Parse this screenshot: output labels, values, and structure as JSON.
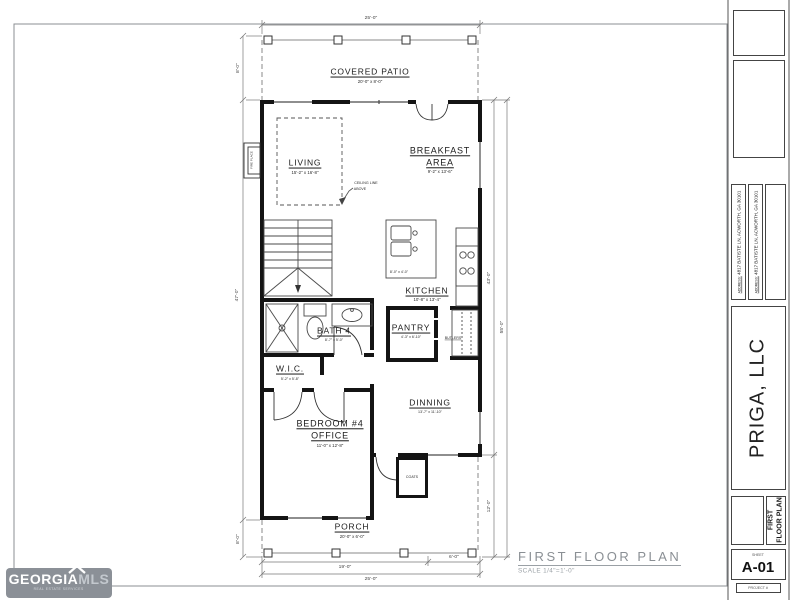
{
  "sheet": {
    "plan_title": "FIRST  FLOOR  PLAN",
    "plan_scale": "SCALE  1/4\"=1'-0\""
  },
  "rooms": {
    "covered_patio": {
      "name": "COVERED PATIO",
      "dims": "20'-0\" x 8'-0\""
    },
    "living": {
      "name": "LIVING",
      "dims": "15'-2\" x 16'-8\""
    },
    "ceiling_note_1": "CEILING LINE",
    "ceiling_note_2": "ABOVE",
    "fireplace": "FIRE PLACE",
    "breakfast": {
      "name1": "BREAKFAST",
      "name2": "AREA",
      "dims": "9'-2\" x 13'-6\""
    },
    "kitchen": {
      "name": "KITCHEN",
      "dims": "10'-8\" x 13'-4\""
    },
    "island_dims": "8'-0\" x 4'-0\"",
    "pantry": {
      "name": "PANTRY",
      "dims": "4'-3\" x 6'-10\""
    },
    "butlers": "BUTLERS",
    "bath4": {
      "name": "BATH 4",
      "dims": "8'-7\" x 5'-0\""
    },
    "wic": {
      "name": "W.I.C.",
      "dims": "5'-2\" x 5'-8\""
    },
    "bedroom4": {
      "name1": "BEDROOM #4",
      "name2": "OFFICE",
      "dims": "11'-0\" x 12'-8\""
    },
    "dining": {
      "name": "DINNING",
      "dims": "13'-7\" x 11'-10\""
    },
    "coats": "COATS",
    "porch": {
      "name": "PORCH",
      "dims": "20'-0\" x 6'-0\""
    }
  },
  "dimensions": {
    "top_width": "25'-0\"",
    "left_patio": "8'-0\"",
    "left_house": "47'-0\"",
    "left_porch": "8'-0\"",
    "right_house": "43'-0\"",
    "right_total": "55'-0\"",
    "right_porch": "12'-0\"",
    "bottom_left": "19'-0\"",
    "bottom_right": "6'-0\"",
    "bottom_total": "25'-0\""
  },
  "titleblock": {
    "address_label": "ADDRESS:",
    "address": "4817 BATISTE LN, ACWORTH, GA 30101",
    "company": "PRIGA, LLC",
    "sheet_name_1": "FIRST",
    "sheet_name_2": "FLOOR PLAN",
    "sheet_label": "SHEET",
    "sheet_number": "A-01",
    "project_label": "PROJECT #"
  },
  "logo": {
    "georgia": "GEORGIA",
    "mls": "MLS",
    "tagline": "REAL ESTATE SERVICES"
  },
  "colors": {
    "wall": "#141414",
    "thin_line": "#4a4a4a",
    "dashed": "#8a8a8a",
    "dim_line": "#777777",
    "logo_bg": "#8b9097"
  }
}
